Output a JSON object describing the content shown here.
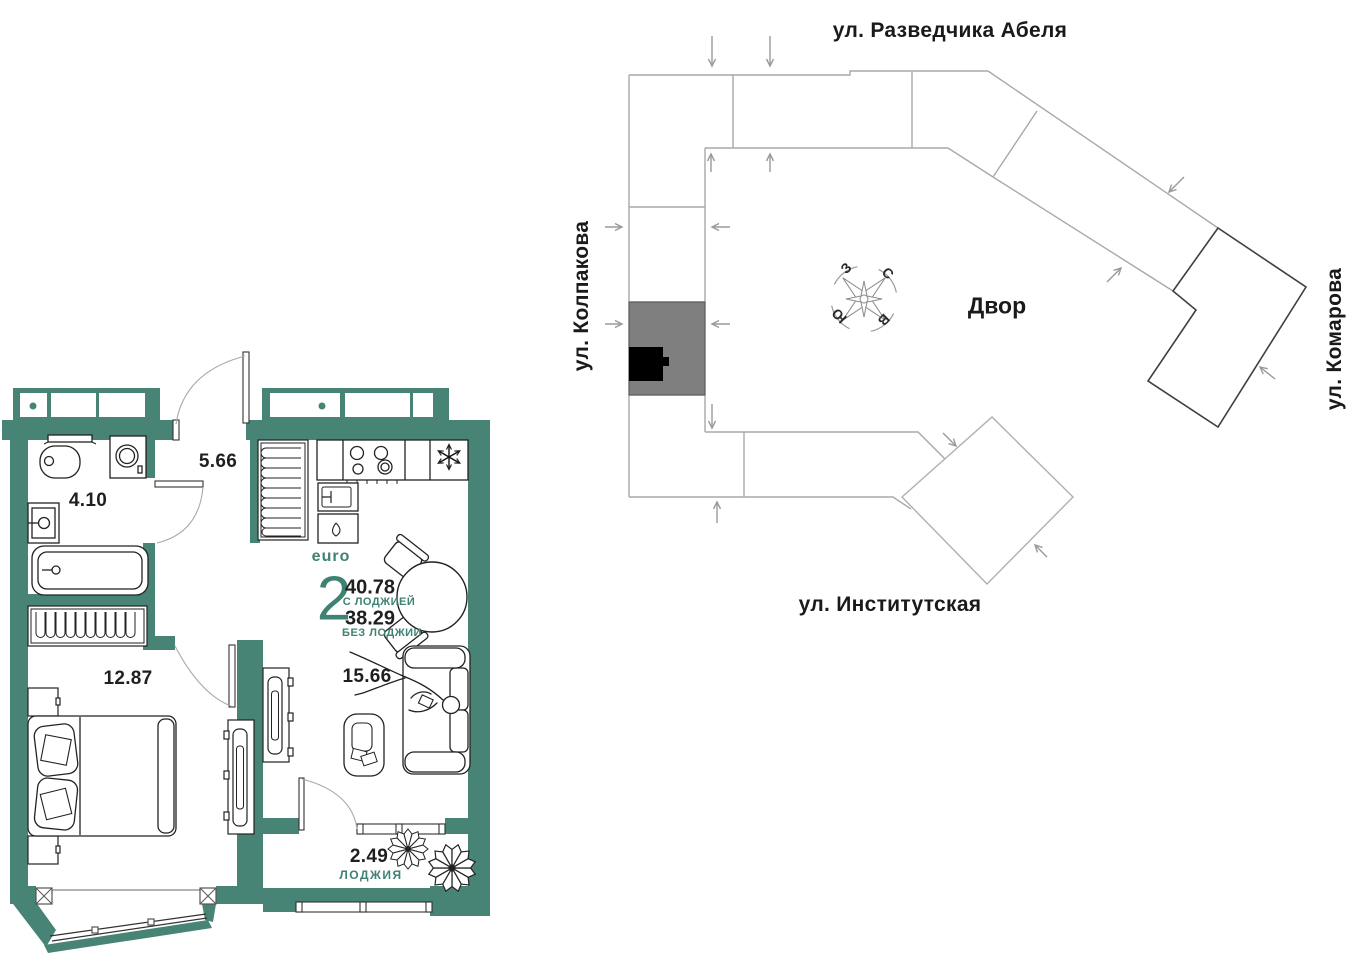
{
  "floorplan": {
    "summary": {
      "plan_type": "euro",
      "rooms_count": "2",
      "area_with_loggia": "40.78",
      "with_loggia_label": "С ЛОДЖИЕЙ",
      "area_without_loggia": "38.29",
      "without_loggia_label": "БЕЗ ЛОДЖИИ"
    },
    "rooms": {
      "bathroom": {
        "area": "4.10"
      },
      "hallway": {
        "area": "5.66"
      },
      "bedroom": {
        "area": "12.87"
      },
      "living_kitchen": {
        "area": "15.66"
      },
      "loggia": {
        "area": "2.49",
        "label": "ЛОДЖИЯ"
      }
    },
    "icons": [
      "fridge-snowflake-icon",
      "plant-icon",
      "person-figure"
    ]
  },
  "siteplan": {
    "streets": {
      "top": "ул. Разведчика Абеля",
      "left": "ул. Колпакова",
      "right": "ул. Комарова",
      "bottom": "ул. Институтская"
    },
    "courtyard_label": "Двор",
    "compass": {
      "north": "С",
      "south": "Ю",
      "west": "З",
      "east": "В"
    }
  },
  "colors": {
    "wall_teal": "#488476",
    "accent_teal": "#3f8173",
    "site_outline": "#a9a9a9",
    "site_outline_dark": "#3f3f3f",
    "highlight_section": "#7f7f7f",
    "apartment_marker": "#000000",
    "text_dark": "#1f1f1f"
  }
}
